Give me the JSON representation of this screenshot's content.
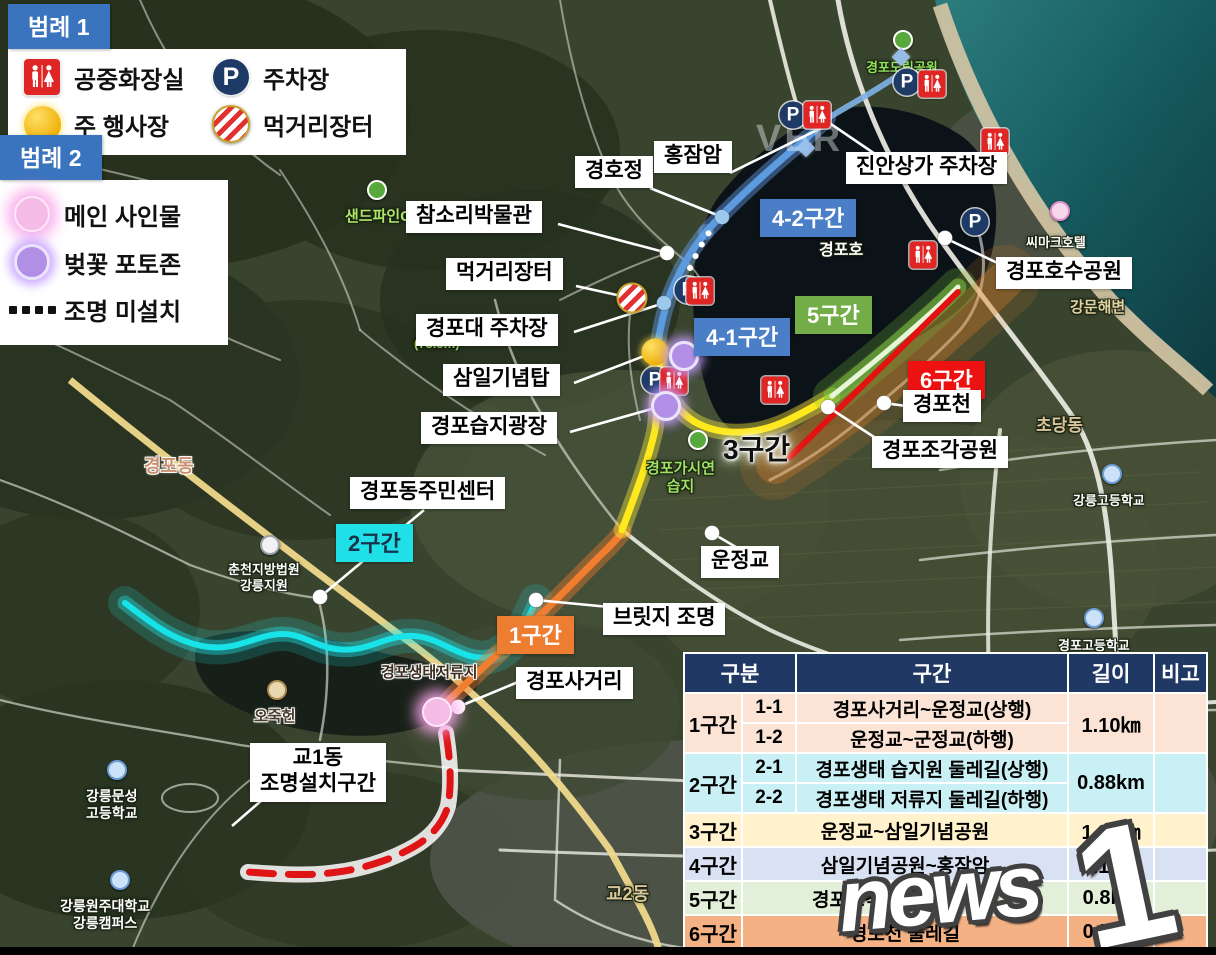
{
  "legend1": {
    "title": "범례 1",
    "items": [
      {
        "icon": "restroom-icon",
        "label": "공중화장실"
      },
      {
        "icon": "parking-icon",
        "label": "주차장"
      },
      {
        "icon": "event-icon",
        "label": "주 행사장"
      },
      {
        "icon": "market-icon",
        "label": "먹거리장터"
      }
    ]
  },
  "legend2": {
    "title": "범례 2",
    "items": [
      {
        "icon": "main-sign-icon",
        "label": "메인 사인물"
      },
      {
        "icon": "photo-zone-icon",
        "label": "벚꽃 포토존"
      },
      {
        "icon": "dotted-line-icon",
        "label": "조명 미설치"
      }
    ]
  },
  "icons": {
    "parking_letter": "P"
  },
  "colors": {
    "badge_blue": "#4a7ec6",
    "badge_green": "#72ad47",
    "badge_red": "#ee1111",
    "badge_orange": "#ed7d31",
    "badge_cyan": "#1fe0e6",
    "table_header": "#1f3864",
    "row_peach": "#fbe3d5",
    "row_cyan": "#c9f1f5",
    "row_yellow": "#fff2cc",
    "row_blue": "#d9e2f3",
    "row_green": "#e2efd9",
    "row_orange": "#f4b183"
  },
  "section_badges": [
    {
      "id": "1",
      "label": "1구간",
      "x": 497,
      "y": 616,
      "bg": "#ed7d31",
      "fg": "#ffffff"
    },
    {
      "id": "2",
      "label": "2구간",
      "x": 336,
      "y": 524,
      "bg": "#1fe0e6",
      "fg": "#17324a"
    },
    {
      "id": "3",
      "label": "3구간",
      "x": 723,
      "y": 428,
      "glow": true
    },
    {
      "id": "4-1",
      "label": "4-1구간",
      "x": 694,
      "y": 318,
      "bg": "#4a7ec6",
      "fg": "#ffffff"
    },
    {
      "id": "4-2",
      "label": "4-2구간",
      "x": 760,
      "y": 199,
      "bg": "#4a7ec6",
      "fg": "#ffffff"
    },
    {
      "id": "5",
      "label": "5구간",
      "x": 795,
      "y": 296,
      "bg": "#72ad47",
      "fg": "#ffffff"
    },
    {
      "id": "6",
      "label": "6구간",
      "x": 908,
      "y": 361,
      "bg": "#ee1111",
      "fg": "#ffffff"
    }
  ],
  "callout_labels": [
    {
      "text": "경호정",
      "x": 575,
      "y": 156
    },
    {
      "text": "홍잠암",
      "x": 654,
      "y": 141
    },
    {
      "text": "진안상가 주차장",
      "x": 846,
      "y": 152
    },
    {
      "text": "참소리박물관",
      "x": 406,
      "y": 201
    },
    {
      "text": "먹거리장터",
      "x": 446,
      "y": 258
    },
    {
      "text": "경포대 주차장",
      "x": 416,
      "y": 314
    },
    {
      "text": "삼일기념탑",
      "x": 443,
      "y": 364
    },
    {
      "text": "경포습지광장",
      "x": 421,
      "y": 412
    },
    {
      "text": "경포동주민센터",
      "x": 350,
      "y": 477
    },
    {
      "text": "경포호수공원",
      "x": 996,
      "y": 257
    },
    {
      "text": "경포천",
      "x": 903,
      "y": 390
    },
    {
      "text": "경포조각공원",
      "x": 872,
      "y": 436
    },
    {
      "text": "운정교",
      "x": 701,
      "y": 546
    },
    {
      "text": "브릿지 조명",
      "x": 603,
      "y": 603
    },
    {
      "text": "경포사거리",
      "x": 516,
      "y": 667
    },
    {
      "text": "교1동\n조명설치구간",
      "x": 250,
      "y": 743
    }
  ],
  "callout_lines": [
    [
      650,
      188,
      722,
      217
    ],
    [
      730,
      173,
      823,
      127
    ],
    [
      878,
      156,
      828,
      122
    ],
    [
      558,
      224,
      664,
      252
    ],
    [
      576,
      286,
      626,
      297
    ],
    [
      574,
      332,
      664,
      303
    ],
    [
      574,
      383,
      652,
      353
    ],
    [
      570,
      432,
      662,
      406
    ],
    [
      424,
      510,
      320,
      597
    ],
    [
      1008,
      268,
      945,
      238
    ],
    [
      906,
      406,
      884,
      403
    ],
    [
      894,
      450,
      828,
      407
    ],
    [
      758,
      560,
      712,
      533
    ],
    [
      640,
      610,
      536,
      600
    ],
    [
      542,
      672,
      458,
      707
    ],
    [
      262,
      800,
      232,
      826
    ]
  ],
  "callout_dots": [
    {
      "x": 320,
      "y": 597,
      "type": "white"
    },
    {
      "x": 945,
      "y": 238,
      "type": "white"
    },
    {
      "x": 884,
      "y": 403,
      "type": "white"
    },
    {
      "x": 828,
      "y": 407,
      "type": "white"
    },
    {
      "x": 712,
      "y": 533,
      "type": "white"
    },
    {
      "x": 536,
      "y": 600,
      "type": "white"
    },
    {
      "x": 458,
      "y": 707,
      "type": "white"
    },
    {
      "x": 667,
      "y": 253,
      "type": "white"
    },
    {
      "x": 722,
      "y": 217,
      "type": "blue"
    },
    {
      "x": 664,
      "y": 303,
      "type": "blue"
    }
  ],
  "markers": [
    {
      "type": "parking",
      "x": 793,
      "y": 115
    },
    {
      "type": "parking",
      "x": 907,
      "y": 82
    },
    {
      "type": "parking",
      "x": 975,
      "y": 222
    },
    {
      "type": "parking",
      "x": 688,
      "y": 290
    },
    {
      "type": "parking",
      "x": 655,
      "y": 380
    },
    {
      "type": "restroom",
      "x": 817,
      "y": 115
    },
    {
      "type": "restroom",
      "x": 932,
      "y": 84
    },
    {
      "type": "restroom",
      "x": 995,
      "y": 142
    },
    {
      "type": "restroom",
      "x": 923,
      "y": 255
    },
    {
      "type": "restroom",
      "x": 775,
      "y": 390
    },
    {
      "type": "restroom",
      "x": 700,
      "y": 291
    },
    {
      "type": "restroom",
      "x": 674,
      "y": 381
    },
    {
      "type": "market",
      "x": 632,
      "y": 298
    },
    {
      "type": "event",
      "x": 655,
      "y": 352
    },
    {
      "type": "photo",
      "x": 684,
      "y": 356
    },
    {
      "type": "photo",
      "x": 666,
      "y": 406
    },
    {
      "type": "main-sign",
      "x": 437,
      "y": 712
    },
    {
      "type": "diamond",
      "x": 806,
      "y": 148
    },
    {
      "type": "diamond",
      "x": 901,
      "y": 57
    }
  ],
  "map_labels": [
    {
      "text": "샌드파인GC",
      "x": 345,
      "y": 208,
      "color": "#aee46a",
      "size": 15,
      "outline": "dark",
      "icon": "green",
      "ix": 377,
      "iy": 190
    },
    {
      "text": "경포도립공원",
      "x": 866,
      "y": 60,
      "color": "#8fe05a",
      "size": 13,
      "outline": "dark",
      "icon": "green",
      "ix": 903,
      "iy": 40
    },
    {
      "text": "경포호",
      "x": 819,
      "y": 241,
      "color": "#ffffff",
      "size": 16,
      "outline": "dark",
      "icon": "water",
      "ix": 842,
      "iy": 220
    },
    {
      "text": "씨마크호텔",
      "x": 1026,
      "y": 235,
      "color": "#ffffff",
      "size": 13,
      "outline": "dark",
      "icon": "hotel",
      "ix": 1060,
      "iy": 211
    },
    {
      "text": "강문해변",
      "x": 1070,
      "y": 299,
      "color": "#e2d3a4",
      "size": 15,
      "outline": "dark"
    },
    {
      "text": "초당동",
      "x": 1036,
      "y": 416,
      "color": "#d9c59b",
      "size": 17,
      "outline": "dark"
    },
    {
      "text": "강릉고등학교",
      "x": 1073,
      "y": 493,
      "color": "#ffffff",
      "size": 13,
      "outline": "dark",
      "icon": "school",
      "ix": 1112,
      "iy": 474
    },
    {
      "text": "경포고등학교",
      "x": 1058,
      "y": 638,
      "color": "#ffffff",
      "size": 13,
      "outline": "dark",
      "icon": "school",
      "ix": 1094,
      "iy": 618
    },
    {
      "text": "경포가시연\n습지",
      "x": 646,
      "y": 460,
      "color": "#9fe065",
      "size": 15,
      "outline": "dark",
      "icon": "green",
      "ix": 698,
      "iy": 440
    },
    {
      "text": "(73.5m)",
      "x": 414,
      "y": 336,
      "color": "#9fe065",
      "size": 13,
      "outline": "dark"
    },
    {
      "text": "경포동",
      "x": 144,
      "y": 456,
      "color": "#c98f6e",
      "size": 18,
      "outline": "light"
    },
    {
      "text": "춘천지방법원\n강릉지원",
      "x": 228,
      "y": 562,
      "color": "#ffffff",
      "size": 13,
      "outline": "dark",
      "icon": "court",
      "ix": 270,
      "iy": 545
    },
    {
      "text": "경포생태저류지",
      "x": 381,
      "y": 664,
      "color": "#3a2d1e",
      "size": 15,
      "outline": "light"
    },
    {
      "text": "오죽헌",
      "x": 254,
      "y": 708,
      "color": "#4a3a28",
      "size": 15,
      "outline": "light",
      "icon": "temple",
      "ix": 277,
      "iy": 690
    },
    {
      "text": "강릉문성\n고등학교",
      "x": 86,
      "y": 788,
      "color": "#ffffff",
      "size": 14,
      "outline": "dark",
      "icon": "school",
      "ix": 117,
      "iy": 770
    },
    {
      "text": "강릉원주대학교\n강릉캠퍼스",
      "x": 60,
      "y": 898,
      "color": "#ffffff",
      "size": 14,
      "outline": "dark",
      "icon": "school",
      "ix": 120,
      "iy": 880
    },
    {
      "text": "교2동",
      "x": 606,
      "y": 884,
      "color": "#d9c59b",
      "size": 18,
      "outline": "dark"
    }
  ],
  "table": {
    "headers": [
      "구분",
      "구간",
      "길이",
      "비고"
    ],
    "groups": [
      {
        "name": "1구간",
        "color": "#fbe3d5",
        "length": "1.10㎞",
        "subs": [
          {
            "no": "1-1",
            "desc": "경포사거리~운정교(상행)"
          },
          {
            "no": "1-2",
            "desc": "운정교~군정교(하행)"
          }
        ]
      },
      {
        "name": "2구간",
        "color": "#c9f1f5",
        "length": "0.88km",
        "subs": [
          {
            "no": "2-1",
            "desc": "경포생태 습지원 둘레길(상행)"
          },
          {
            "no": "2-2",
            "desc": "경포생태 저류지 둘레길(하행)"
          }
        ]
      },
      {
        "name": "3구간",
        "color": "#fff2cc",
        "length": "1.28㎞",
        "subs": [
          {
            "no": "",
            "desc": "운정교~삼일기념공원"
          }
        ]
      },
      {
        "name": "4구간",
        "color": "#d9e2f3",
        "length": "1.17㎞",
        "subs": [
          {
            "no": "",
            "desc": "삼일기념공원~홍잠암"
          }
        ]
      },
      {
        "name": "5구간",
        "color": "#e2efd9",
        "length": "0.8km",
        "subs": [
          {
            "no": "",
            "desc": "경포조각공원~진안상가"
          }
        ]
      },
      {
        "name": "6구간",
        "color": "#f4b183",
        "length": "0.5km",
        "subs": [
          {
            "no": "",
            "desc": "경포천 둘레길"
          }
        ]
      }
    ]
  },
  "watermarks": {
    "naver_fragment": "VER",
    "news": "news",
    "one": "1"
  }
}
